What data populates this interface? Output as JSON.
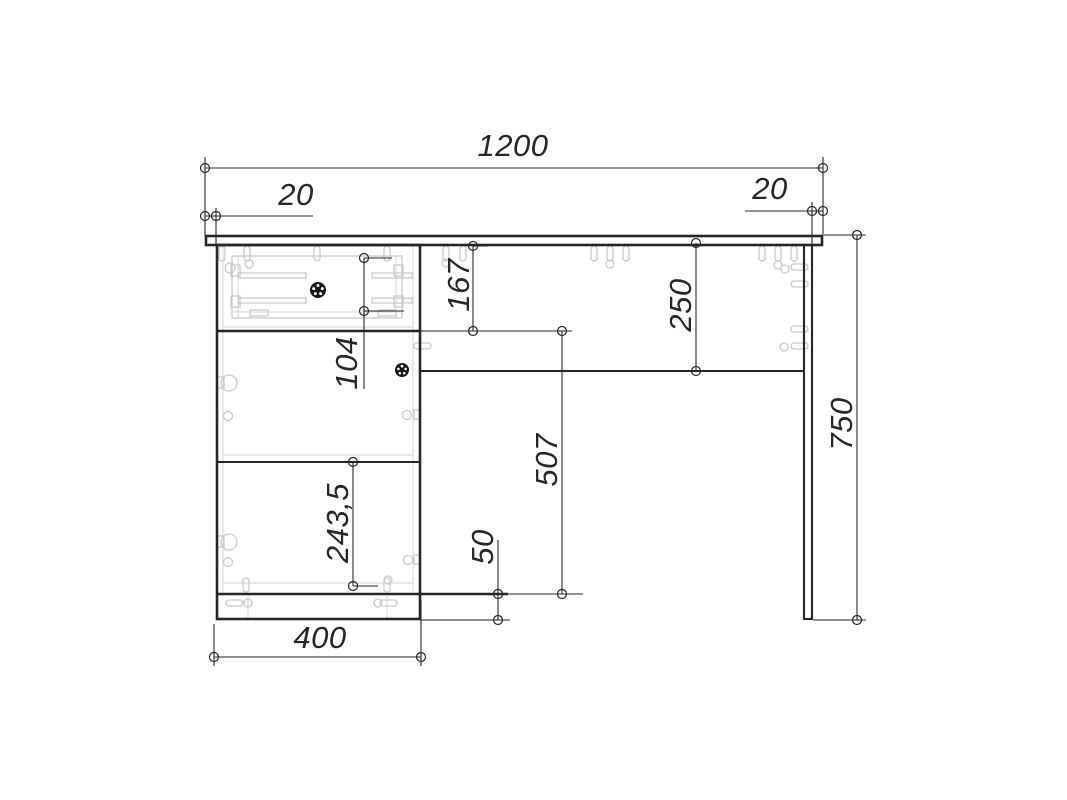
{
  "drawing": {
    "view": "furniture-desk-front-assembly-drawing",
    "units": "mm",
    "background_color": "#ffffff",
    "line_color": "#262626",
    "hardware_color": "#c9c9c9",
    "dims": {
      "total_width": "1200",
      "left_overhang": "20",
      "right_overhang": "20",
      "drawer_front_height": "167",
      "apron_height": "250",
      "drawer_box_height": "104",
      "knee_opening_height": "507",
      "shelf_compartment_height": "243,5",
      "plinth_height": "50",
      "cabinet_width": "400",
      "total_height": "750"
    }
  }
}
